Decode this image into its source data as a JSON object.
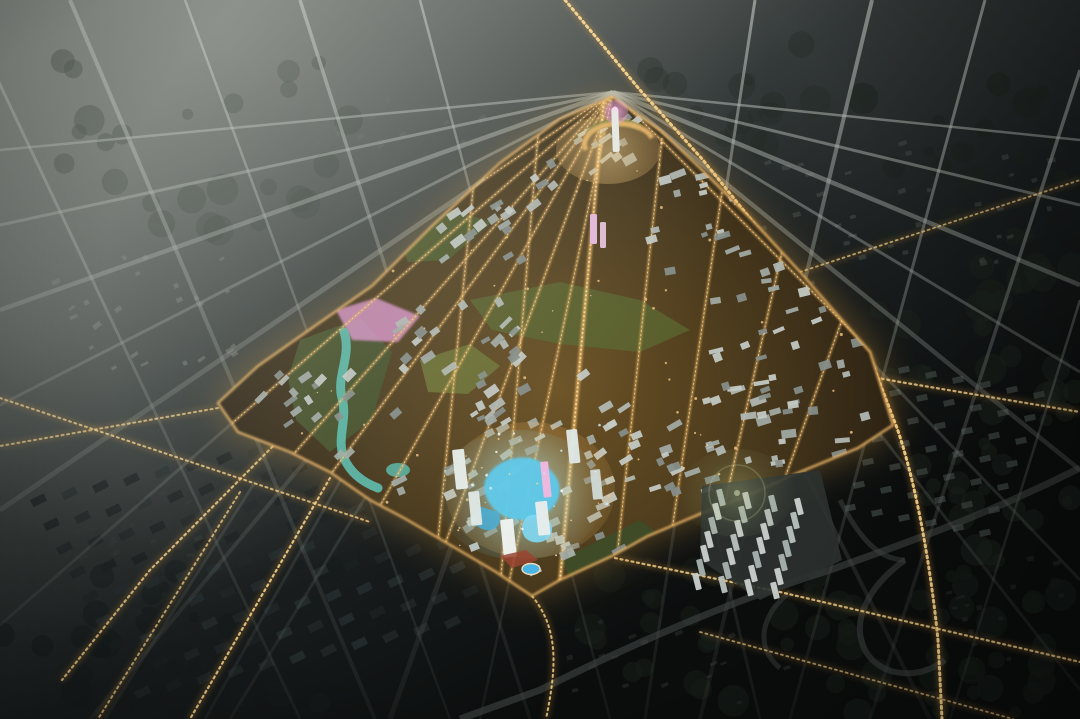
{
  "scene": {
    "type": "aerial-night-architectural-rendering",
    "subject": "Bird's-eye dusk rendering of an illuminated master-planned urban district surrounded by a dark existing city grid",
    "time_of_day": "dusk",
    "visible_text": "none"
  },
  "palette": {
    "haze_gray": "#cdd2c8",
    "city_mid": "#3c4241",
    "city_dark": "#121616",
    "road_gray": "#a6ada8",
    "district_base": "#3a2c18",
    "district_halo": "#c08a34",
    "street_gold": "#e9b264",
    "street_bright": "#ffe2a0",
    "trail_gold": "#ffd98f",
    "trail_glow": "#c98f3a",
    "building_light": "#c5cbc6",
    "building_mid": "#a3aba6",
    "building_dark": "#878f8b",
    "row_house_dark": "#1f2425",
    "park_green": "#4f5a2c",
    "park_bright": "#6d7435",
    "roof_green": "#7d8440",
    "water_teal": "#5bbcae",
    "core_cyan": "#5fc9ea",
    "stadium_blue": "#4ab4e4",
    "accent_pink": "#df96cf",
    "tower_white": "#e9ebe7",
    "plaza_red": "#9a4430",
    "flare_green": "#c8d89a",
    "window_warm": "#ffd289"
  },
  "regions": [
    {
      "name": "sky-haze",
      "description": "milky fog lit from upper left"
    },
    {
      "name": "dark-city-fabric",
      "description": "unlit surrounding city blocks, trees and row housing"
    },
    {
      "name": "road-grid",
      "description": "gray streets converging toward the district apex"
    },
    {
      "name": "illuminated-district",
      "description": "triangular golden-lit new town core"
    },
    {
      "name": "apex-tower",
      "description": "white landmark tower with pink-lit crown at the district apex"
    },
    {
      "name": "crescent-plaza",
      "description": "gold crescent street below the apex tower"
    },
    {
      "name": "central-boulevard",
      "description": "bright spine running from apex to south tip"
    },
    {
      "name": "cyan-core",
      "description": "blue-glowing organic landmark roofs at district center"
    },
    {
      "name": "riverfront-park",
      "description": "teal stream and green corridor on the west side"
    },
    {
      "name": "pink-lit-park",
      "description": "magenta illuminated lawn on the west edge"
    },
    {
      "name": "white-residential-cluster",
      "description": "pale slab housing southeast of the district"
    },
    {
      "name": "highway-interchange",
      "description": "dark looping ramps with golden light trails, lower right"
    },
    {
      "name": "light-trails",
      "description": "dotted golden head/tail lights on arterial roads"
    },
    {
      "name": "stadium",
      "description": "small blue oval venue near the south tip"
    },
    {
      "name": "lens-flare",
      "description": "faint green-yellow flare circle right of center"
    }
  ]
}
